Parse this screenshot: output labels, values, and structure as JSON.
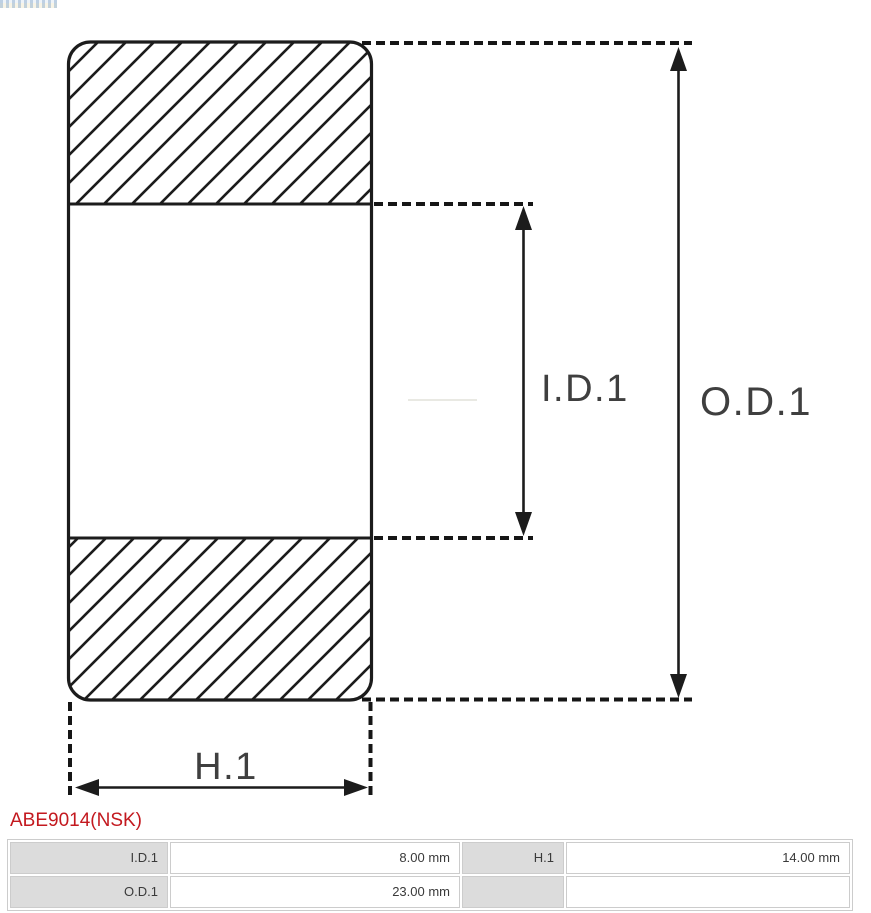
{
  "diagram": {
    "labels": {
      "inner_diameter": "I.D.1",
      "outer_diameter": "O.D.1",
      "height": "H.1"
    },
    "colors": {
      "line": "#1c1c1c",
      "label": "#3f3f3f"
    }
  },
  "product": {
    "code": "ABE9014(NSK)",
    "code_color": "#c3191f"
  },
  "spec_table": {
    "rows": [
      {
        "cells": [
          {
            "label": "I.D.1",
            "value": "8.00 mm"
          },
          {
            "label": "H.1",
            "value": "14.00 mm"
          }
        ]
      },
      {
        "cells": [
          {
            "label": "O.D.1",
            "value": "23.00 mm"
          },
          {
            "label": "",
            "value": ""
          }
        ]
      }
    ]
  }
}
